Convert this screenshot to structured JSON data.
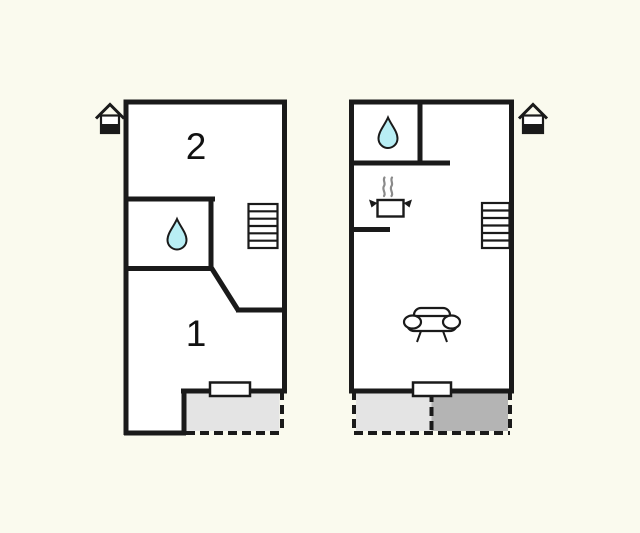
{
  "background": "#FAFAEE",
  "colors": {
    "wall": "#1A1A1A",
    "room_interior": "#FFFFFF",
    "water_drop": "#B8EEF4",
    "terrace_light": "#E4E4E4",
    "terrace_dark": "#B4B4B4",
    "steam": "#8A8A8A",
    "label": "#111111"
  },
  "left_plan": {
    "room_label_upper": "2",
    "room_label_lower": "1",
    "icons": [
      "house-icon",
      "water-drop-icon",
      "stairs-icon",
      "door-icon"
    ]
  },
  "right_plan": {
    "icons": [
      "house-icon",
      "water-drop-icon",
      "cooking-pot-icon",
      "stairs-icon",
      "sofa-icon",
      "door-icon"
    ]
  }
}
